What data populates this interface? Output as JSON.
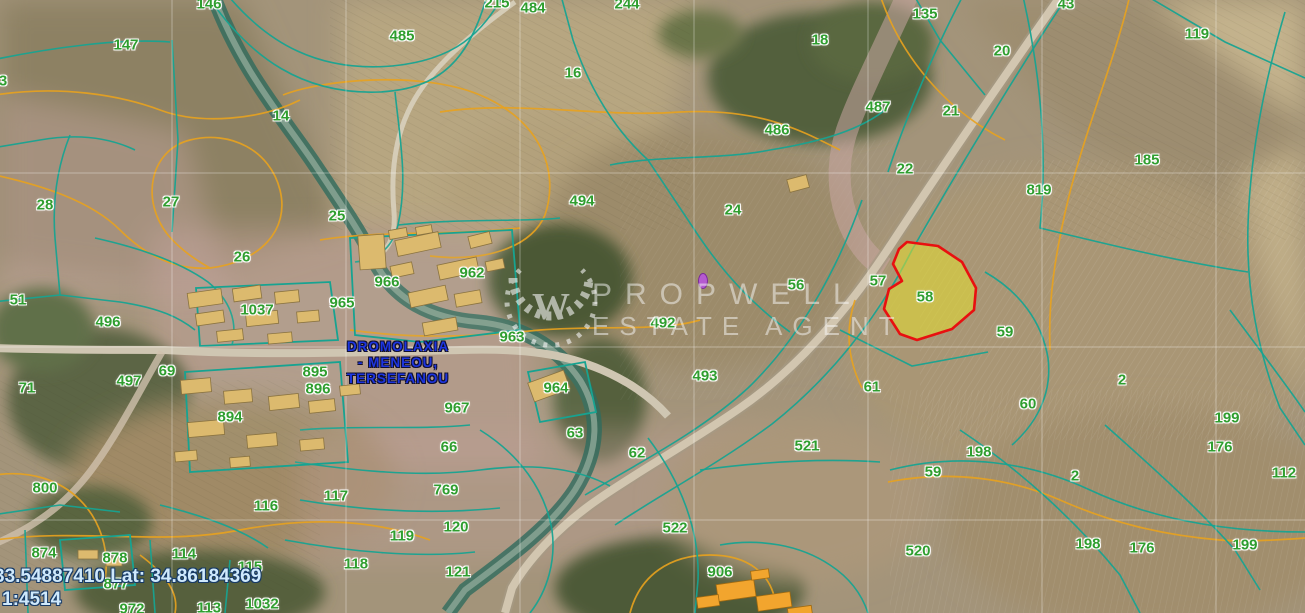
{
  "map": {
    "coordinates_label": "33.54887410 Lat: 34.86184369",
    "scale_label": "1:4514",
    "place_label": {
      "line1": "DROMOLAXIA",
      "line2": "- MENEOU,",
      "line3": "TERSEFANOU"
    },
    "watermark": {
      "brand": "PROPWELL",
      "tagline": "ESTATE AGENT",
      "monogram": "W"
    },
    "highlighted_parcel": {
      "number": "58"
    },
    "colors": {
      "parcel_label_green": "#2f9e2f",
      "boundary_teal": "#17a391",
      "contour_orange": "#e8a21e",
      "highlight_fill": "#e6e030",
      "highlight_stroke": "#e81010",
      "place_label_blue": "#1d35e0",
      "coordinates_blue": "#cfe9fc"
    },
    "parcel_labels": [
      {
        "text": "146",
        "x": 209,
        "y": 4
      },
      {
        "text": "147",
        "x": 126,
        "y": 45
      },
      {
        "text": "3",
        "x": 3,
        "y": 81
      },
      {
        "text": "485",
        "x": 402,
        "y": 36
      },
      {
        "text": "215",
        "x": 497,
        "y": 3
      },
      {
        "text": "484",
        "x": 533,
        "y": 8
      },
      {
        "text": "244",
        "x": 627,
        "y": 4
      },
      {
        "text": "16",
        "x": 573,
        "y": 73
      },
      {
        "text": "494",
        "x": 582,
        "y": 201
      },
      {
        "text": "14",
        "x": 281,
        "y": 116
      },
      {
        "text": "27",
        "x": 171,
        "y": 202
      },
      {
        "text": "28",
        "x": 45,
        "y": 205
      },
      {
        "text": "25",
        "x": 337,
        "y": 216
      },
      {
        "text": "26",
        "x": 242,
        "y": 257
      },
      {
        "text": "18",
        "x": 820,
        "y": 40
      },
      {
        "text": "486",
        "x": 777,
        "y": 130
      },
      {
        "text": "487",
        "x": 878,
        "y": 107
      },
      {
        "text": "135",
        "x": 925,
        "y": 14
      },
      {
        "text": "21",
        "x": 951,
        "y": 111
      },
      {
        "text": "22",
        "x": 905,
        "y": 169
      },
      {
        "text": "20",
        "x": 1002,
        "y": 51
      },
      {
        "text": "43",
        "x": 1066,
        "y": 4
      },
      {
        "text": "119",
        "x": 1197,
        "y": 34
      },
      {
        "text": "185",
        "x": 1147,
        "y": 160
      },
      {
        "text": "819",
        "x": 1039,
        "y": 190
      },
      {
        "text": "24",
        "x": 733,
        "y": 210
      },
      {
        "text": "56",
        "x": 796,
        "y": 285
      },
      {
        "text": "57",
        "x": 878,
        "y": 281
      },
      {
        "text": "58",
        "x": 925,
        "y": 297
      },
      {
        "text": "59",
        "x": 1005,
        "y": 332
      },
      {
        "text": "51",
        "x": 18,
        "y": 300
      },
      {
        "text": "496",
        "x": 108,
        "y": 322
      },
      {
        "text": "966",
        "x": 387,
        "y": 282
      },
      {
        "text": "962",
        "x": 472,
        "y": 273
      },
      {
        "text": "965",
        "x": 342,
        "y": 303
      },
      {
        "text": "1037",
        "x": 257,
        "y": 310
      },
      {
        "text": "963",
        "x": 512,
        "y": 337
      },
      {
        "text": "492",
        "x": 663,
        "y": 323
      },
      {
        "text": "69",
        "x": 167,
        "y": 371
      },
      {
        "text": "71",
        "x": 27,
        "y": 388
      },
      {
        "text": "497",
        "x": 129,
        "y": 381
      },
      {
        "text": "895",
        "x": 315,
        "y": 372
      },
      {
        "text": "896",
        "x": 318,
        "y": 389
      },
      {
        "text": "964",
        "x": 556,
        "y": 388
      },
      {
        "text": "967",
        "x": 457,
        "y": 408
      },
      {
        "text": "894",
        "x": 230,
        "y": 417
      },
      {
        "text": "61",
        "x": 872,
        "y": 387
      },
      {
        "text": "493",
        "x": 705,
        "y": 376
      },
      {
        "text": "800",
        "x": 45,
        "y": 488
      },
      {
        "text": "66",
        "x": 449,
        "y": 447
      },
      {
        "text": "63",
        "x": 575,
        "y": 433
      },
      {
        "text": "62",
        "x": 637,
        "y": 453
      },
      {
        "text": "2",
        "x": 1122,
        "y": 380
      },
      {
        "text": "60",
        "x": 1028,
        "y": 404
      },
      {
        "text": "199",
        "x": 1227,
        "y": 418
      },
      {
        "text": "176",
        "x": 1220,
        "y": 447
      },
      {
        "text": "198",
        "x": 979,
        "y": 452
      },
      {
        "text": "59",
        "x": 933,
        "y": 472
      },
      {
        "text": "2",
        "x": 1075,
        "y": 476
      },
      {
        "text": "112",
        "x": 1284,
        "y": 473
      },
      {
        "text": "769",
        "x": 446,
        "y": 490
      },
      {
        "text": "117",
        "x": 336,
        "y": 496
      },
      {
        "text": "116",
        "x": 266,
        "y": 506
      },
      {
        "text": "120",
        "x": 456,
        "y": 527
      },
      {
        "text": "119",
        "x": 402,
        "y": 536
      },
      {
        "text": "118",
        "x": 356,
        "y": 564
      },
      {
        "text": "121",
        "x": 458,
        "y": 572
      },
      {
        "text": "521",
        "x": 807,
        "y": 446
      },
      {
        "text": "522",
        "x": 675,
        "y": 528
      },
      {
        "text": "906",
        "x": 720,
        "y": 572
      },
      {
        "text": "520",
        "x": 918,
        "y": 551
      },
      {
        "text": "198",
        "x": 1088,
        "y": 544
      },
      {
        "text": "176",
        "x": 1142,
        "y": 548
      },
      {
        "text": "199",
        "x": 1245,
        "y": 545
      },
      {
        "text": "874",
        "x": 44,
        "y": 553
      },
      {
        "text": "878",
        "x": 115,
        "y": 558
      },
      {
        "text": "114",
        "x": 184,
        "y": 554
      },
      {
        "text": "115",
        "x": 250,
        "y": 567
      },
      {
        "text": "877",
        "x": 116,
        "y": 584
      },
      {
        "text": "113",
        "x": 209,
        "y": 608
      },
      {
        "text": "1032",
        "x": 262,
        "y": 604
      },
      {
        "text": "972",
        "x": 132,
        "y": 609
      }
    ]
  }
}
